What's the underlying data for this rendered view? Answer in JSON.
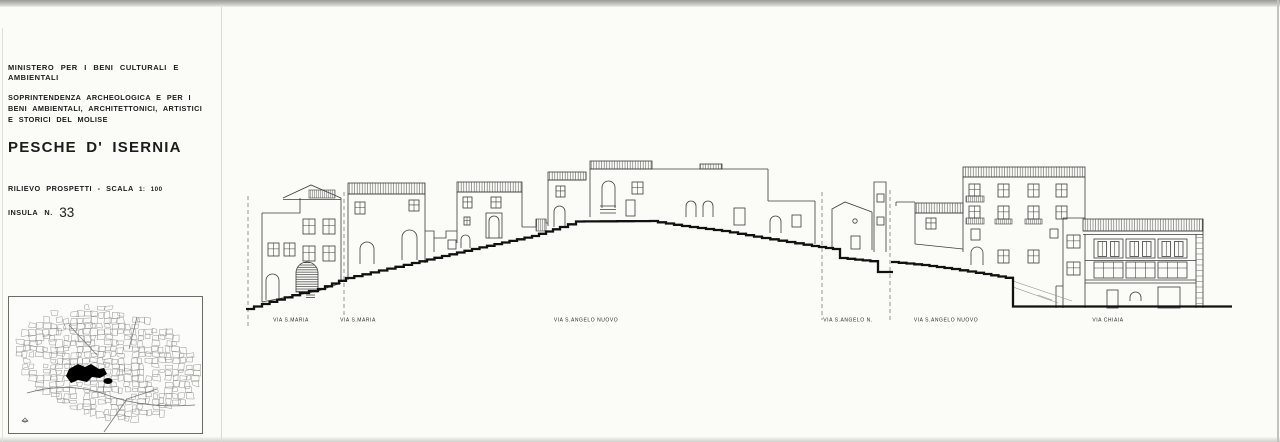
{
  "document": {
    "ministry": "MINISTERO PER I BENI CULTURALI E AMBIENTALI",
    "authority_lines": [
      "SOPRINTENDENZA ARCHEOLOGICA E PER I",
      "BENI AMBIENTALI, ARCHITETTONICI, ARTISTICI",
      "E STORICI DEL MOLISE"
    ],
    "title": "PESCHE D' ISERNIA",
    "survey_label": "RILIEVO PROSPETTI",
    "survey_separator": "-",
    "scale_label": "SCALA",
    "scale_value": "1: 100",
    "insula_label": "INSULA",
    "insula_n_label": "N.",
    "insula_number": "33"
  },
  "drawing": {
    "type": "street-elevation",
    "street_labels": [
      {
        "text": "VIA S.MARIA",
        "x": 291
      },
      {
        "text": "VIA S.MARIA",
        "x": 358
      },
      {
        "text": "VIA S.ANGELO NUOVO",
        "x": 586
      },
      {
        "text": "VIA S.ANGELO N.",
        "x": 848
      },
      {
        "text": "VIA S.ANGELO NUOVO",
        "x": 946
      },
      {
        "text": "VIA CHIAIA",
        "x": 1108
      }
    ]
  },
  "map": {
    "description": "cadastral-location-map-with-highlighted-insula"
  },
  "colors": {
    "paper": "#fbfbf8",
    "drawing_line": "#3c3c3c",
    "ground_line": "#111111",
    "text": "#1c1c1c",
    "insula_fill": "#000000"
  }
}
